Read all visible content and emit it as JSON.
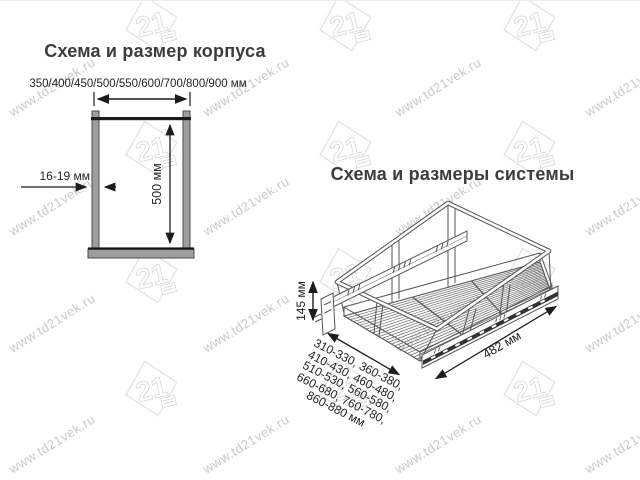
{
  "watermark": {
    "url_text": "www.td21vek.ru",
    "logo_text": "21"
  },
  "left_diagram": {
    "title": "Схема и размер корпуса",
    "width_options": "350/400/450/500/550/600/700/800/900 мм",
    "thickness_label": "16-19 мм",
    "height_label": "500 мм"
  },
  "right_diagram": {
    "title": "Схема и размеры системы",
    "height_label": "145 мм",
    "depth_label": "482 мм",
    "width_ranges": [
      "310-330, 360-380,",
      "410-430, 460-480,",
      "510-530, 560-580,",
      "660-680, 760-780,",
      "860-880 мм"
    ]
  },
  "colors": {
    "dimension_line": "#1c1c1c",
    "drawing_line": "#555555",
    "panel_fill": "#9e9e9e",
    "panel_stroke": "#4d4d4d",
    "text": "#242424",
    "title": "#3c3c3c",
    "watermark_text": "#c9c9c9",
    "watermark_logo": "#e0e0e0"
  }
}
